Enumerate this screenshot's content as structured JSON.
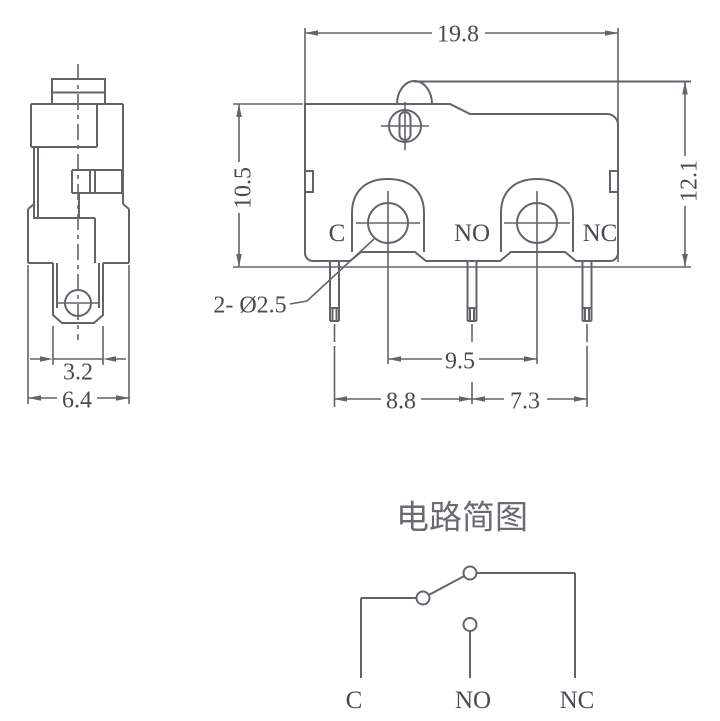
{
  "colors": {
    "line": "#63646a",
    "text": "#4a4b50",
    "background": "#ffffff"
  },
  "front_view": {
    "label_c": "C",
    "label_no": "NO",
    "label_nc": "NC",
    "dim_overall_width": "19.8",
    "dim_body_height": "10.5",
    "dim_total_height": "12.1",
    "dim_hole_spacing": "9.5",
    "dim_pin_spacing_left": "8.8",
    "dim_pin_spacing_right": "7.3",
    "hole_callout": "2- Ø2.5"
  },
  "side_view": {
    "dim_terminal_width": "3.2",
    "dim_depth": "6.4"
  },
  "circuit": {
    "title": "电路简图",
    "label_c": "C",
    "label_no": "NO",
    "label_nc": "NC"
  }
}
